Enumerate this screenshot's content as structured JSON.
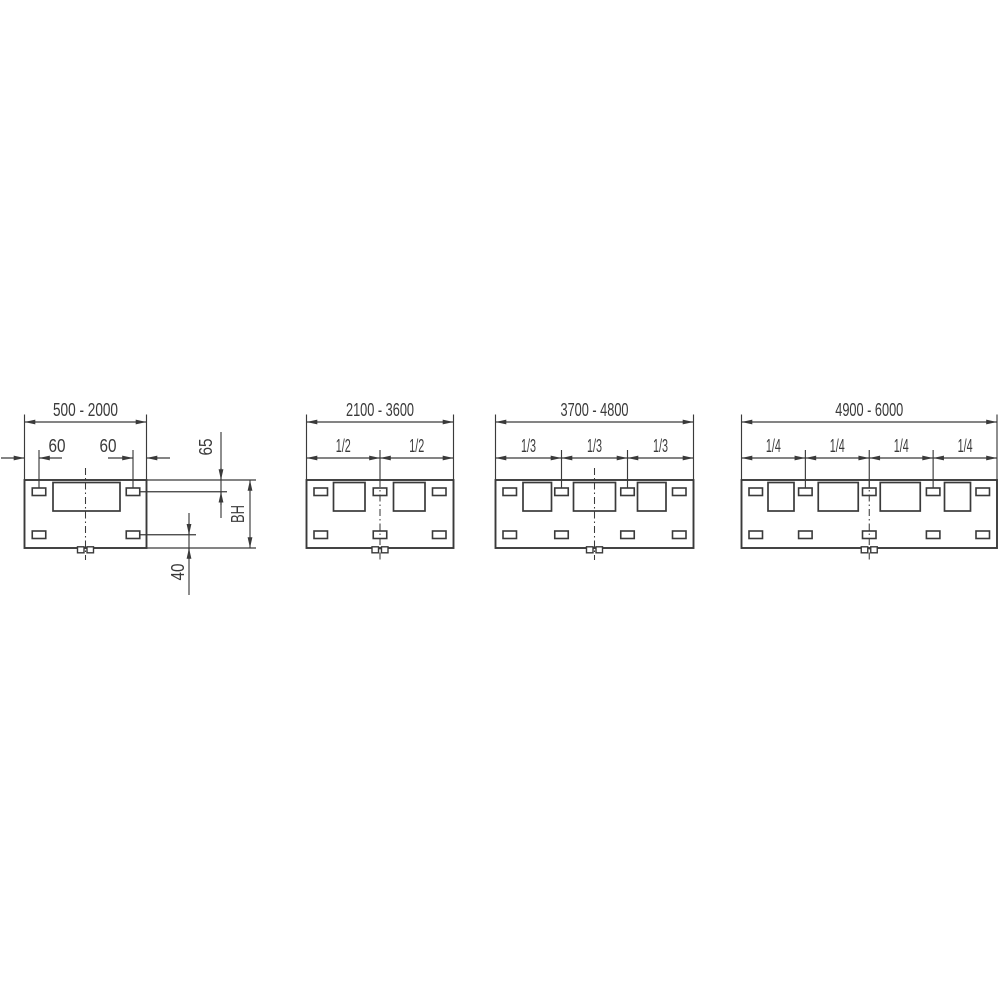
{
  "colors": {
    "line": "#3a3a3a",
    "background": "#ffffff"
  },
  "diagrams": [
    {
      "id": "width-500-2000",
      "range_label": "500 - 2000",
      "left_offset_label": "60",
      "right_offset_label": "60",
      "top_slot_offset_label": "65",
      "height_label": "BH",
      "bottom_slot_offset_label": "40"
    },
    {
      "id": "width-2100-3600",
      "range_label": "2100 - 3600",
      "fraction_labels": [
        "1/2",
        "1/2"
      ]
    },
    {
      "id": "width-3700-4800",
      "range_label": "3700 - 4800",
      "fraction_labels": [
        "1/3",
        "1/3",
        "1/3"
      ]
    },
    {
      "id": "width-4900-6000",
      "range_label": "4900 - 6000",
      "fraction_labels": [
        "1/4",
        "1/4",
        "1/4",
        "1/4"
      ]
    }
  ]
}
